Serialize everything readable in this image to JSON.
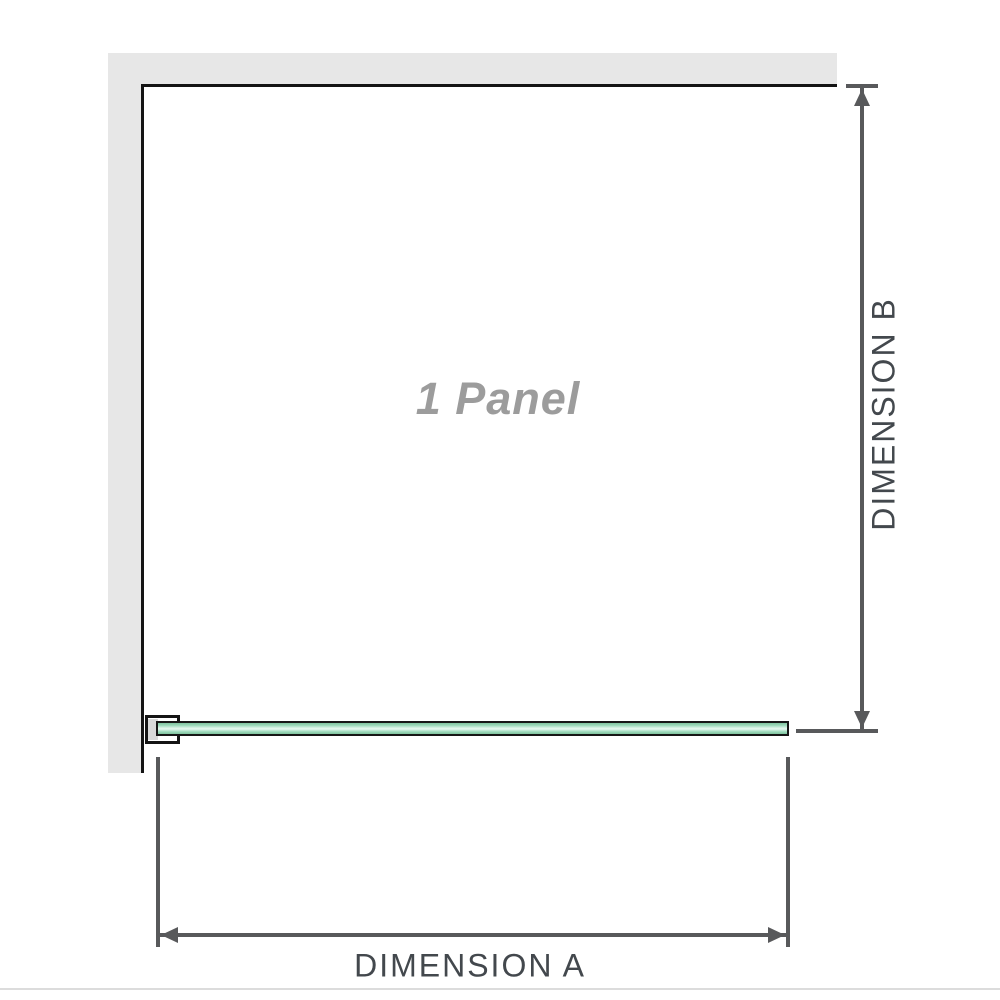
{
  "diagram": {
    "panel_label": "1 Panel",
    "dimension_a": {
      "label": "DIMENSION A",
      "orientation": "horizontal"
    },
    "dimension_b": {
      "label": "DIMENSION B",
      "orientation": "vertical"
    },
    "colors": {
      "wall": "#e7e7e7",
      "outline": "#141414",
      "dimension_line": "#58595b",
      "dimension_text": "#43484d",
      "panel_label_text": "#9c9c9c",
      "glass_green_dark": "#7fc29e",
      "glass_green_mid": "#9cd9ba",
      "glass_green_light": "#e2f6ec",
      "footer_rule": "#dcdcdc"
    }
  }
}
